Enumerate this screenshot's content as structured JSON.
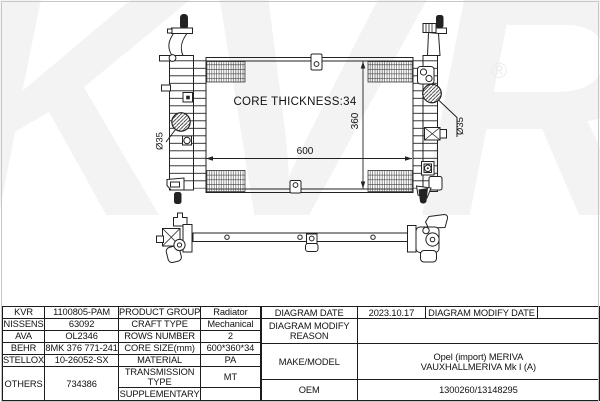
{
  "watermark": {
    "brand": "KVR",
    "registered": "®"
  },
  "front_view": {
    "core_thickness": "CORE THICKNESS:34",
    "core_width": "600",
    "core_height": "360",
    "left_port": "Ø35",
    "right_port": "Ø35"
  },
  "table": {
    "left": {
      "rows": [
        {
          "brand": "KVR",
          "code": "1100805-PAM",
          "property": "PRODUCT GROUP",
          "value": "Radiator"
        },
        {
          "brand": "NISSENS",
          "code": "63092",
          "property": "CRAFT TYPE",
          "value": "Mechanical"
        },
        {
          "brand": "AVA",
          "code": "OL2346",
          "property": "ROWS NUMBER",
          "value": "2"
        },
        {
          "brand": "BEHR",
          "code": "8MK 376 771-241",
          "property": "CORE SIZE(mm)",
          "value": "600*360*34"
        },
        {
          "brand": "STELLOX",
          "code": "10-26052-SX",
          "property": "MATERIAL",
          "value": "PA"
        },
        {
          "brand": "OTHERS",
          "code": "734386",
          "property": "TRANSMISSION TYPE",
          "value": "MT"
        },
        {
          "property": "SUPPLEMENTARY",
          "value": ""
        }
      ]
    },
    "right": {
      "diagram_date_label": "DIAGRAM DATE",
      "diagram_date": "2023.10.17",
      "diagram_modify_date_label": "DIAGRAM MODIFY DATE",
      "diagram_modify_date": "",
      "diagram_modify_reason_label": "DIAGRAM MODIFY REASON",
      "diagram_modify_reason": "",
      "make_model_label": "MAKE/MODEL",
      "make_model_line1": "Opel (import) MERIVA",
      "make_model_line2": "VAUXHALLMERIVA Mk I (A)",
      "oem_label": "OEM",
      "oem_value": "1300260/13148295"
    }
  }
}
